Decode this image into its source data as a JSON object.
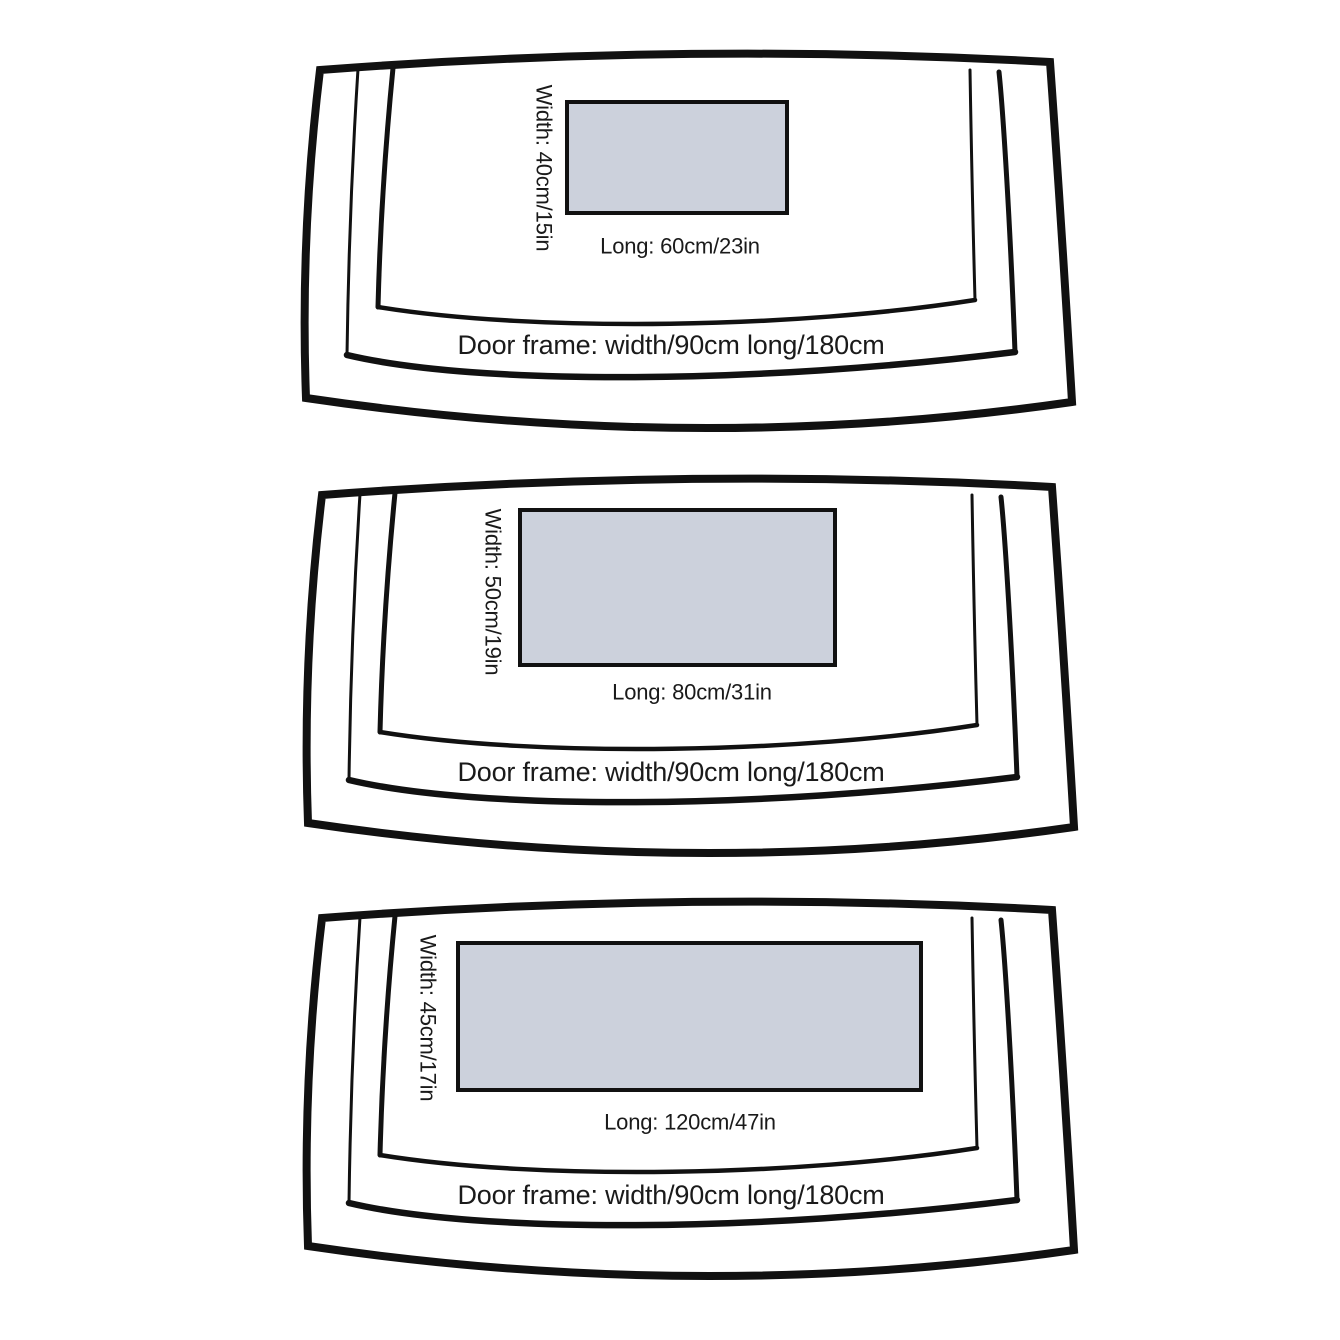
{
  "colors": {
    "background": "#ffffff",
    "stroke": "#111111",
    "mat_fill": "#ccd1dc",
    "text": "#1a1a1a"
  },
  "panels": [
    {
      "name": "small-mat-size",
      "width_label": "Width: 40cm/15in",
      "long_label": "Long:  60cm/23in",
      "door_frame_label": "Door frame:  width/90cm  long/180cm",
      "mat": {
        "x": 269,
        "y": 62,
        "width": 220,
        "height": 111
      },
      "width_label_pos": {
        "x": 246,
        "y": 128
      },
      "long_label_pos": {
        "x": 382,
        "y": 206
      },
      "door_label_pos": {
        "x": 373,
        "y": 305
      }
    },
    {
      "name": "medium-mat-size",
      "width_label": "Width: 50cm/19in",
      "long_label": "Long:  80cm/31in",
      "door_frame_label": "Door frame:  width/90cm  long/180cm",
      "mat": {
        "x": 220,
        "y": 45,
        "width": 315,
        "height": 155
      },
      "width_label_pos": {
        "x": 193,
        "y": 127
      },
      "long_label_pos": {
        "x": 392,
        "y": 227
      },
      "door_label_pos": {
        "x": 371,
        "y": 307
      }
    },
    {
      "name": "large-mat-size",
      "width_label": "Width: 45cm/17in",
      "long_label": "Long:  120cm/47in",
      "door_frame_label": "Door frame:  width/90cm  long/180cm",
      "mat": {
        "x": 158,
        "y": 55,
        "width": 463,
        "height": 147
      },
      "width_label_pos": {
        "x": 128,
        "y": 130
      },
      "long_label_pos": {
        "x": 390,
        "y": 234
      },
      "door_label_pos": {
        "x": 371,
        "y": 307
      }
    }
  ]
}
